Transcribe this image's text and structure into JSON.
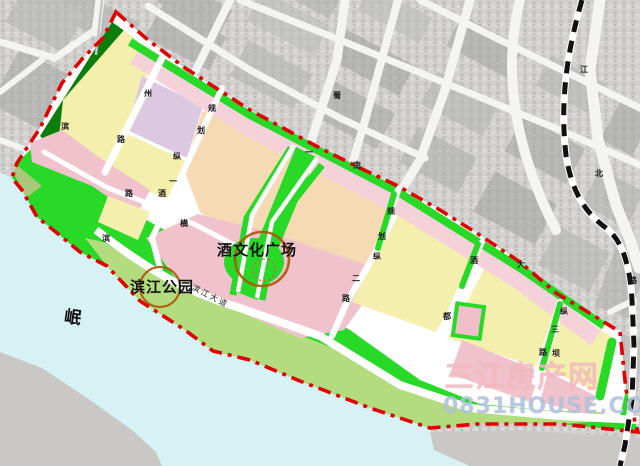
{
  "map": {
    "landmarks": {
      "plaza": "酒文化广场",
      "park": "滨江公园",
      "river": "岷"
    },
    "riverside_road": "滨江大道",
    "road_labels": [
      {
        "t": "滨",
        "x": 61,
        "y": 123
      },
      {
        "t": "州",
        "x": 144,
        "y": 90
      },
      {
        "t": "路",
        "x": 117,
        "y": 136
      },
      {
        "t": "规",
        "x": 208,
        "y": 105
      },
      {
        "t": "划",
        "x": 197,
        "y": 127
      },
      {
        "t": "纵",
        "x": 173,
        "y": 153
      },
      {
        "t": "一",
        "x": 169,
        "y": 178
      },
      {
        "t": "路",
        "x": 125,
        "y": 190
      },
      {
        "t": "酒",
        "x": 158,
        "y": 190
      },
      {
        "t": "横",
        "x": 180,
        "y": 220
      },
      {
        "t": "滨",
        "x": 102,
        "y": 235
      },
      {
        "t": "蜀",
        "x": 333,
        "y": 92
      },
      {
        "t": "一",
        "x": 305,
        "y": 149
      },
      {
        "t": "南",
        "x": 353,
        "y": 162
      },
      {
        "t": "规",
        "x": 387,
        "y": 208
      },
      {
        "t": "划",
        "x": 378,
        "y": 233
      },
      {
        "t": "纵",
        "x": 373,
        "y": 253
      },
      {
        "t": "二",
        "x": 352,
        "y": 275
      },
      {
        "t": "路",
        "x": 342,
        "y": 295
      },
      {
        "t": "大",
        "x": 517,
        "y": 261
      },
      {
        "t": "酒",
        "x": 470,
        "y": 257
      },
      {
        "t": "都",
        "x": 443,
        "y": 313
      },
      {
        "t": "纵",
        "x": 560,
        "y": 308
      },
      {
        "t": "三",
        "x": 551,
        "y": 326
      },
      {
        "t": "路",
        "x": 539,
        "y": 349
      },
      {
        "t": "坝",
        "x": 552,
        "y": 350
      },
      {
        "t": "江",
        "x": 580,
        "y": 66
      },
      {
        "t": "北",
        "x": 595,
        "y": 170
      },
      {
        "t": "路",
        "x": 629,
        "y": 277
      }
    ],
    "watermark": {
      "line1": "三江房产网",
      "line2": "0831HOUSE.COM"
    },
    "colors": {
      "boundary_red": "#e10000",
      "bright_green": "#28d928",
      "dark_green": "#0b7d0b",
      "park_green": "#b2dc7e",
      "residential_yellow": "#f4efad",
      "mixed_pink": "#f0c2cb",
      "strip_pink": "#f5d2da",
      "lavender": "#dcc8e0",
      "commercial_orange": "#f6dab4",
      "river_cyan": "#d7f2f5",
      "road_white": "#ffffff",
      "railway_black": "#111111",
      "landmark_circle_orange": "#ad5508",
      "watermark_pink": "#f2c0c6",
      "watermark_blue": "#a9c8e4"
    }
  }
}
